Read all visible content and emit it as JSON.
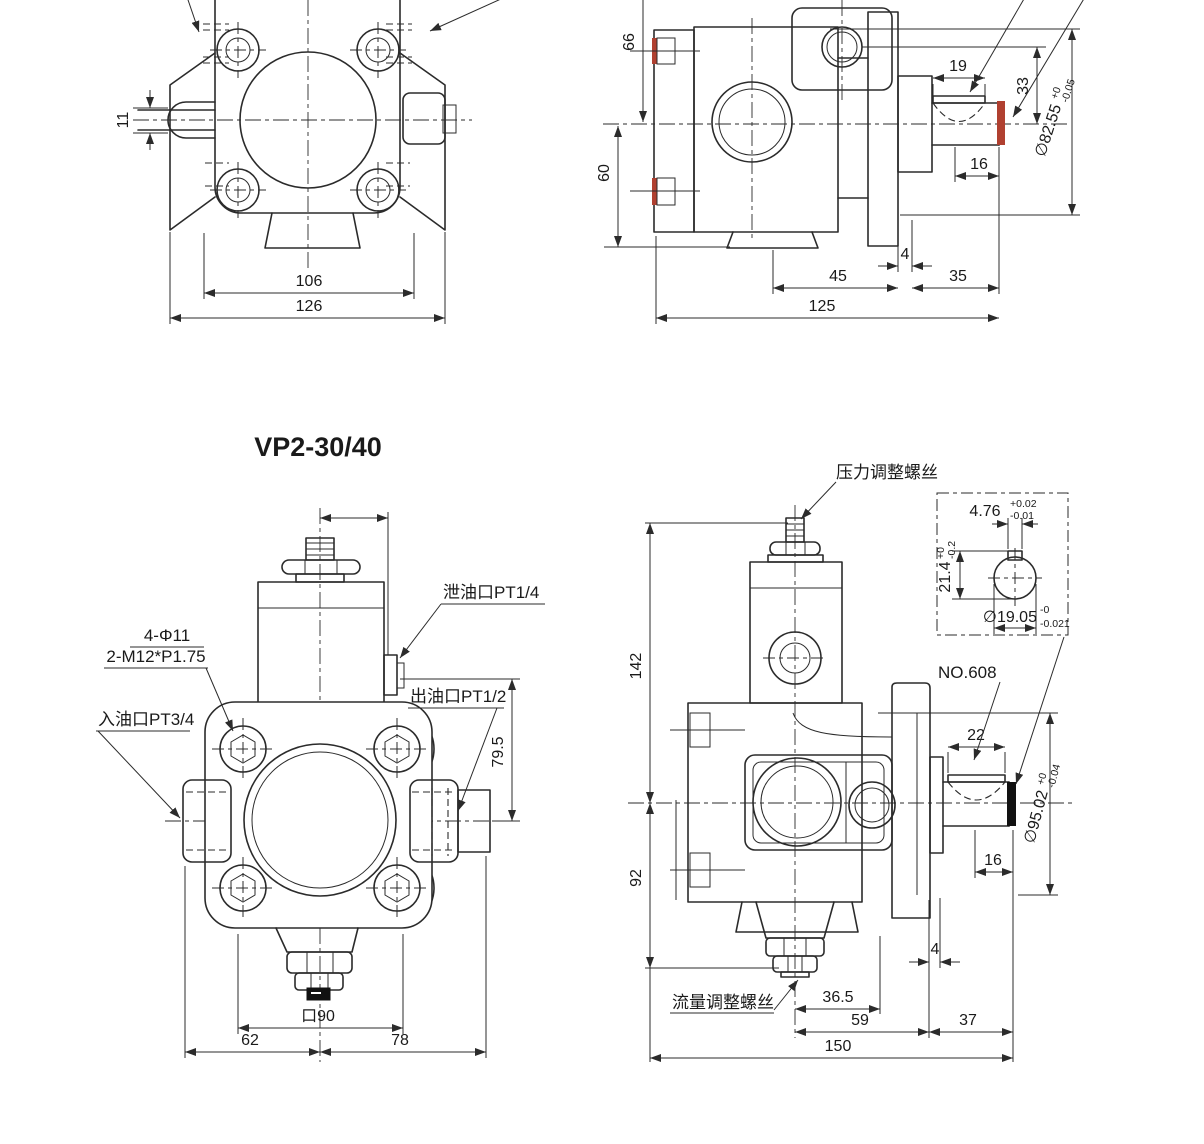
{
  "drawing": {
    "title": "VP2-30/40",
    "colors": {
      "line": "#2b2b2b",
      "seal_red": "#b04030",
      "plug_black": "#111111",
      "background": "#ffffff"
    }
  },
  "front_view_a": {
    "dims": {
      "shaft_w": "11",
      "bolt_span": "106",
      "overall": "126"
    }
  },
  "side_view_a": {
    "dims": {
      "h66": "66",
      "h60": "60",
      "key_len": "19",
      "h33": "33",
      "end16": "16",
      "gap4": "4",
      "w45": "45",
      "w35": "35",
      "overall": "125"
    },
    "shaft_dia": {
      "value": "∅82.55",
      "tol_up": "+0",
      "tol_dn": "-0.05"
    }
  },
  "front_view_b": {
    "labels": {
      "drain_port": "泄油口PT1/4",
      "mount_holes": "4-Φ11",
      "thread_holes": "2-M12*P1.75",
      "inlet_port": "入油口PT3/4",
      "outlet_port": "出油口PT1/2"
    },
    "dims": {
      "v795": "79.5",
      "square": "口90",
      "w62": "62",
      "w78": "78"
    }
  },
  "side_view_b": {
    "labels": {
      "pressure_screw": "压力调整螺丝",
      "flow_screw": "流量调整螺丝",
      "bearing_no": "NO.608"
    },
    "dims": {
      "h142": "142",
      "h92": "92",
      "key22": "22",
      "end16": "16",
      "gap4": "4",
      "w365": "36.5",
      "w59": "59",
      "w37": "37",
      "overall": "150"
    },
    "shaft_dia": {
      "value": "∅95.02",
      "tol_up": "+0",
      "tol_dn": "-0.04"
    },
    "key_detail": {
      "key_width": {
        "value": "4.76",
        "tol_up": "+0.02",
        "tol_dn": "-0.01"
      },
      "key_height": {
        "value": "21.4",
        "tol_up": "+0",
        "tol_dn": "-0.2"
      },
      "key_dia": {
        "value": "∅19.05",
        "tol_up": "-0",
        "tol_dn": "-0.021"
      }
    }
  }
}
